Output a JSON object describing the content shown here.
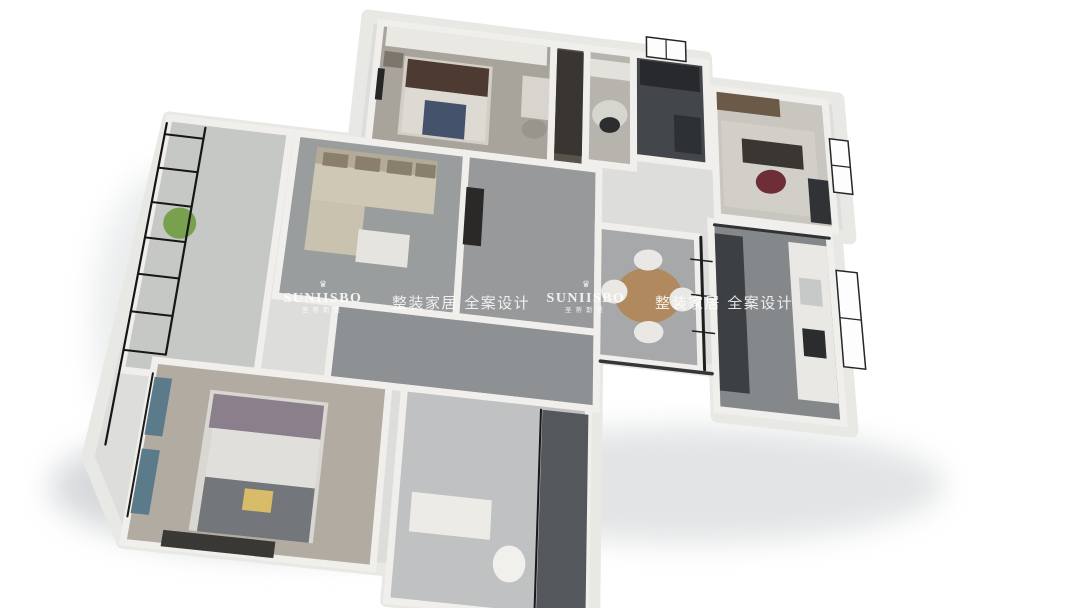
{
  "watermarks": [
    {
      "brand": "SUNIISBO",
      "brand_cn": "圣蒂斯堡",
      "tagline": "整装家居 全案设计",
      "crown_glyph": "♛"
    },
    {
      "brand": "SUNIISBO",
      "brand_cn": "圣蒂斯堡",
      "tagline": "整装家居 全案设计",
      "crown_glyph": "♛"
    }
  ],
  "floorplan": {
    "description": "3D isometric rendering of a three-bedroom apartment floor plan, white background",
    "colors": {
      "background": "#ffffff",
      "wall_fill": "#dddddc",
      "wall_inner": "#f0efec",
      "wall_outer": "#e8e8e5",
      "window_frame": "#26262a",
      "glass_black": "#17181a"
    },
    "projection": {
      "plan_quad": [
        [
          28,
          0
        ],
        [
          100,
          13
        ],
        [
          97,
          63
        ],
        [
          0,
          79
        ]
      ],
      "screen_quad": [
        [
          368,
          16
        ],
        [
          848,
          141
        ],
        [
          852,
          431
        ],
        [
          88,
          457
        ]
      ]
    },
    "shadows": [
      {
        "name": "shadow-bottom-left",
        "cx": 300,
        "cy": 487,
        "rx": 250,
        "ry": 68,
        "color": "#aeb4b8",
        "opacity": 0.5
      },
      {
        "name": "shadow-bottom-right",
        "cx": 690,
        "cy": 485,
        "rx": 255,
        "ry": 58,
        "color": "#b4b9bc",
        "opacity": 0.38
      },
      {
        "name": "shadow-left",
        "cx": 168,
        "cy": 320,
        "rx": 75,
        "ry": 150,
        "color": "#c2c7ca",
        "opacity": 0.32
      }
    ],
    "outline": [
      [
        28,
        0
      ],
      [
        79,
        0
      ],
      [
        79,
        5
      ],
      [
        99,
        5
      ],
      [
        99,
        31
      ],
      [
        97,
        31
      ],
      [
        97,
        63
      ],
      [
        79,
        63
      ],
      [
        79,
        56
      ],
      [
        63,
        56
      ],
      [
        63,
        94
      ],
      [
        38,
        94
      ],
      [
        38,
        90
      ],
      [
        6,
        90
      ],
      [
        0,
        79
      ],
      [
        2,
        24
      ],
      [
        28,
        24
      ]
    ],
    "rooms": [
      {
        "name": "bedroom-2",
        "rect": [
          30,
          1,
          56,
          24
        ],
        "floor": "#a8a39b"
      },
      {
        "name": "closet",
        "rect": [
          56,
          1,
          61,
          24
        ],
        "floor": "#57524a"
      },
      {
        "name": "dressing-nook",
        "rect": [
          61,
          1,
          68,
          23
        ],
        "floor": "#b7b4ae"
      },
      {
        "name": "bathroom-top",
        "rect": [
          68,
          1,
          79,
          21
        ],
        "floor": "#43464a"
      },
      {
        "name": "study",
        "rect": [
          80,
          6,
          97,
          30
        ],
        "floor": "#c9c6c0"
      },
      {
        "name": "hallway",
        "rect": [
          44,
          24,
          63,
          56
        ],
        "floor": "#97999b"
      },
      {
        "name": "corridor",
        "rect": [
          28,
          52,
          63,
          64
        ],
        "floor": "#8e9194"
      },
      {
        "name": "living-room",
        "rect": [
          20,
          24,
          44,
          52
        ],
        "floor": "#9a9d9e"
      },
      {
        "name": "balcony",
        "rect": [
          2,
          24,
          19,
          66
        ],
        "floor": "#c5c8c4"
      },
      {
        "name": "master-bedroom",
        "rect": [
          6,
          64,
          36,
          90
        ],
        "floor": "#b2aba1"
      },
      {
        "name": "bathroom-bottom",
        "rect": [
          38,
          64,
          62,
          94
        ],
        "floor": "#bfc1c3"
      },
      {
        "name": "dining-room",
        "rect": [
          63,
          34,
          77,
          56
        ],
        "floor": "#a6a8aa"
      },
      {
        "name": "kitchen",
        "rect": [
          79,
          31,
          96,
          62
        ],
        "floor": "#85888b"
      }
    ],
    "furniture": [
      {
        "name": "wardrobe",
        "shape": "rect",
        "rect": [
          31,
          1.5,
          55,
          5.5
        ],
        "color": "#e9e8e3"
      },
      {
        "name": "bed-2-base",
        "shape": "rect",
        "rect": [
          34,
          7,
          47,
          22
        ],
        "color": "#d3cec6"
      },
      {
        "name": "bed-2-headboard",
        "shape": "rect",
        "rect": [
          34.5,
          7.5,
          46.5,
          13
        ],
        "color": "#4d3a30"
      },
      {
        "name": "bed-2-duvet",
        "shape": "rect",
        "rect": [
          34.5,
          13,
          46.5,
          21.5
        ],
        "color": "#ddd9d3"
      },
      {
        "name": "bed-2-runner",
        "shape": "rect",
        "rect": [
          37.5,
          15,
          43.5,
          21.5
        ],
        "color": "#44536b"
      },
      {
        "name": "nightstand-2",
        "shape": "rect",
        "rect": [
          31,
          6.5,
          33.8,
          9.5
        ],
        "color": "#7d766c"
      },
      {
        "name": "tv-bedroom-2",
        "shape": "rect",
        "rect": [
          30.3,
          10,
          31.3,
          16
        ],
        "color": "#262626"
      },
      {
        "name": "desk-2",
        "shape": "rect",
        "rect": [
          51.5,
          8,
          55.5,
          16
        ],
        "color": "#d9d5ce"
      },
      {
        "name": "chair-2",
        "shape": "ellipse",
        "c": [
          53.5,
          18
        ],
        "r": [
          1.8,
          1.8
        ],
        "color": "#9a958c"
      },
      {
        "name": "closet-cabinet",
        "shape": "rect",
        "rect": [
          56.5,
          2,
          60.5,
          22
        ],
        "color": "#393530"
      },
      {
        "name": "nook-rug",
        "shape": "ellipse",
        "c": [
          64.5,
          13.5
        ],
        "r": [
          2.6,
          2.8
        ],
        "color": "#d7d5d0"
      },
      {
        "name": "nook-desk",
        "shape": "rect",
        "rect": [
          61.5,
          3,
          67.5,
          6.5
        ],
        "color": "#e3e1dc"
      },
      {
        "name": "nook-chair",
        "shape": "ellipse",
        "c": [
          64.5,
          15.5
        ],
        "r": [
          1.5,
          1.5
        ],
        "color": "#2c2d2f"
      },
      {
        "name": "bath-top-shower",
        "shape": "rect",
        "rect": [
          69,
          2,
          78,
          7
        ],
        "color": "#27292c"
      },
      {
        "name": "bath-top-vanity",
        "shape": "rect",
        "rect": [
          74,
          12,
          78,
          19
        ],
        "color": "#2e3134"
      },
      {
        "name": "study-shelf",
        "shape": "rect",
        "rect": [
          80.5,
          6.5,
          90,
          10
        ],
        "color": "#6b5a47"
      },
      {
        "name": "study-rug",
        "shape": "rect",
        "rect": [
          81,
          12,
          95,
          28
        ],
        "color": "#d2cfc9"
      },
      {
        "name": "study-desk",
        "shape": "rect",
        "rect": [
          84,
          15,
          93,
          19.5
        ],
        "color": "#3a3733"
      },
      {
        "name": "study-chair",
        "shape": "ellipse",
        "c": [
          88,
          22.5
        ],
        "r": [
          2.2,
          2.2
        ],
        "color": "#6d2e37"
      },
      {
        "name": "study-cabinet",
        "shape": "rect",
        "rect": [
          93.5,
          21,
          96.5,
          29
        ],
        "color": "#303336"
      },
      {
        "name": "hall-sideboard",
        "shape": "rect",
        "rect": [
          44.3,
          30,
          46.8,
          40
        ],
        "color": "#2b2927"
      },
      {
        "name": "sofa-back",
        "shape": "rect",
        "rect": [
          23,
          26,
          40,
          29
        ],
        "color": "#b3ab97"
      },
      {
        "name": "sofa-seat",
        "shape": "rect",
        "rect": [
          23,
          29,
          40,
          35.5
        ],
        "color": "#cfc8b5"
      },
      {
        "name": "sofa-chaise",
        "shape": "rect",
        "rect": [
          23,
          35.5,
          30.5,
          44
        ],
        "color": "#c9c2af"
      },
      {
        "name": "sofa-cushion-1",
        "shape": "rect",
        "rect": [
          24,
          26.8,
          27.5,
          29.2
        ],
        "color": "#897f6b"
      },
      {
        "name": "sofa-cushion-2",
        "shape": "rect",
        "rect": [
          28.5,
          26.8,
          32,
          29.2
        ],
        "color": "#897f6b"
      },
      {
        "name": "sofa-cushion-3",
        "shape": "rect",
        "rect": [
          33,
          26.8,
          36.5,
          29.2
        ],
        "color": "#897f6b"
      },
      {
        "name": "sofa-cushion-4",
        "shape": "rect",
        "rect": [
          37,
          26.8,
          39.8,
          29.2
        ],
        "color": "#897f6b"
      },
      {
        "name": "coffee-table",
        "shape": "rect",
        "rect": [
          30,
          39.5,
          37,
          45
        ],
        "color": "#e6e4df"
      },
      {
        "name": "balcony-plant",
        "shape": "ellipse",
        "c": [
          6,
          42
        ],
        "r": [
          2.2,
          2.6
        ],
        "color": "#79a04f"
      },
      {
        "name": "dining-table",
        "shape": "ellipse",
        "c": [
          70,
          45
        ],
        "r": [
          4.6,
          4.6
        ],
        "color": "#b08a5e"
      },
      {
        "name": "dining-chair-1",
        "shape": "ellipse",
        "c": [
          70,
          39
        ],
        "r": [
          2,
          1.8
        ],
        "color": "#e9e8e4"
      },
      {
        "name": "dining-chair-2",
        "shape": "ellipse",
        "c": [
          70,
          51
        ],
        "r": [
          2,
          1.8
        ],
        "color": "#e9e8e4"
      },
      {
        "name": "dining-chair-3",
        "shape": "ellipse",
        "c": [
          65.3,
          45
        ],
        "r": [
          1.8,
          2
        ],
        "color": "#e9e8e4"
      },
      {
        "name": "dining-chair-4",
        "shape": "ellipse",
        "c": [
          74.7,
          45
        ],
        "r": [
          1.8,
          2
        ],
        "color": "#e9e8e4"
      },
      {
        "name": "kitchen-cabinets",
        "shape": "rect",
        "rect": [
          79.5,
          33,
          83.5,
          59
        ],
        "color": "#3c4043"
      },
      {
        "name": "kitchen-counter",
        "shape": "rect",
        "rect": [
          90,
          33,
          95.5,
          59
        ],
        "color": "#e9e8e4"
      },
      {
        "name": "kitchen-sink",
        "shape": "rect",
        "rect": [
          91.2,
          39,
          94.3,
          43.5
        ],
        "color": "#c6c9c7"
      },
      {
        "name": "kitchen-stove",
        "shape": "rect",
        "rect": [
          91.2,
          47.5,
          94.3,
          52
        ],
        "color": "#2a2c2e"
      },
      {
        "name": "bath-bottom-vanity",
        "shape": "rect",
        "rect": [
          40,
          79,
          50,
          84.5
        ],
        "color": "#edebe6"
      },
      {
        "name": "toilet",
        "shape": "ellipse",
        "c": [
          52.5,
          87.5
        ],
        "r": [
          2,
          2.5
        ],
        "color": "#f1f0ed"
      },
      {
        "name": "shower-dark",
        "shape": "rect",
        "rect": [
          56,
          65,
          62,
          93
        ],
        "color": "#54585c"
      },
      {
        "name": "master-bed-base",
        "shape": "rect",
        "rect": [
          13.5,
          67.5,
          28.5,
          87.5
        ],
        "color": "#d9d7d1"
      },
      {
        "name": "master-pillows",
        "shape": "rect",
        "rect": [
          14,
          68,
          28,
          73
        ],
        "color": "#8b7f8c"
      },
      {
        "name": "master-duvet",
        "shape": "rect",
        "rect": [
          14.5,
          73,
          28,
          80
        ],
        "color": "#e1dfdb"
      },
      {
        "name": "master-blanket",
        "shape": "rect",
        "rect": [
          14.5,
          80,
          28,
          87.5
        ],
        "color": "#73767a"
      },
      {
        "name": "master-yellow-pillow",
        "shape": "rect",
        "rect": [
          19.5,
          81,
          23,
          84
        ],
        "color": "#d8bc6a"
      },
      {
        "name": "master-curtain-1",
        "shape": "rect",
        "rect": [
          6.3,
          66.5,
          8.5,
          75
        ],
        "color": "#5b7a8a"
      },
      {
        "name": "master-curtain-2",
        "shape": "rect",
        "rect": [
          6.3,
          77,
          8.5,
          86
        ],
        "color": "#5b7a8a"
      },
      {
        "name": "master-dresser",
        "shape": "rect",
        "rect": [
          10.5,
          87.8,
          24,
          90
        ],
        "color": "#3a3835"
      }
    ],
    "lines": [
      {
        "name": "balcony-glass-rail-outer",
        "pts": [
          [
            1.8,
            25
          ],
          [
            1.8,
            77
          ]
        ],
        "color": "#161616",
        "w": 2.2
      },
      {
        "name": "balcony-glass-rail-inner",
        "pts": [
          [
            7.2,
            25
          ],
          [
            7.2,
            63
          ]
        ],
        "color": "#161616",
        "w": 2.2
      },
      {
        "name": "balcony-glass-rung-1",
        "pts": [
          [
            1.8,
            27
          ],
          [
            7.2,
            27
          ]
        ],
        "color": "#161616",
        "w": 2
      },
      {
        "name": "balcony-glass-rung-2",
        "pts": [
          [
            1.8,
            33
          ],
          [
            7.2,
            33
          ]
        ],
        "color": "#161616",
        "w": 2
      },
      {
        "name": "balcony-glass-rung-3",
        "pts": [
          [
            1.8,
            39
          ],
          [
            7.2,
            39
          ]
        ],
        "color": "#161616",
        "w": 2
      },
      {
        "name": "balcony-glass-rung-4",
        "pts": [
          [
            1.8,
            45
          ],
          [
            7.2,
            45
          ]
        ],
        "color": "#161616",
        "w": 2
      },
      {
        "name": "balcony-glass-rung-5",
        "pts": [
          [
            1.8,
            51
          ],
          [
            7.2,
            51
          ]
        ],
        "color": "#161616",
        "w": 2
      },
      {
        "name": "balcony-glass-rung-6",
        "pts": [
          [
            1.8,
            57
          ],
          [
            7.2,
            57
          ]
        ],
        "color": "#161616",
        "w": 2
      },
      {
        "name": "balcony-glass-rung-7",
        "pts": [
          [
            1.8,
            63
          ],
          [
            7.2,
            63
          ]
        ],
        "color": "#161616",
        "w": 2
      },
      {
        "name": "master-window-frame",
        "pts": [
          [
            6,
            66
          ],
          [
            6,
            86.5
          ]
        ],
        "color": "#1a1a1a",
        "w": 2
      },
      {
        "name": "dining-partition-glass",
        "pts": [
          [
            77.5,
            34
          ],
          [
            77.5,
            56
          ]
        ],
        "color": "#1d1f21",
        "w": 3
      },
      {
        "name": "partition-tick-1",
        "pts": [
          [
            76,
            38
          ],
          [
            79,
            38
          ]
        ],
        "color": "#1d1f21",
        "w": 1.5
      },
      {
        "name": "partition-tick-2",
        "pts": [
          [
            76,
            44
          ],
          [
            79,
            44
          ]
        ],
        "color": "#1d1f21",
        "w": 1.5
      },
      {
        "name": "partition-tick-3",
        "pts": [
          [
            76,
            50
          ],
          [
            79,
            50
          ]
        ],
        "color": "#1d1f21",
        "w": 1.5
      },
      {
        "name": "dining-wall-cap",
        "pts": [
          [
            63.5,
            56.5
          ],
          [
            78.5,
            56.5
          ]
        ],
        "color": "#34373a",
        "w": 3.5
      },
      {
        "name": "kitchen-hood-cap",
        "pts": [
          [
            79.5,
            31.5
          ],
          [
            96,
            31.5
          ]
        ],
        "color": "#303336",
        "w": 3
      },
      {
        "name": "shower-glass",
        "pts": [
          [
            55.8,
            65
          ],
          [
            55.8,
            93
          ]
        ],
        "color": "#17181a",
        "w": 2
      }
    ],
    "windows": [
      {
        "name": "window-bathroom-top",
        "pts": [
          [
            70,
            -2.8
          ],
          [
            76,
            -2.8
          ],
          [
            76,
            1.2
          ],
          [
            70,
            1.2
          ]
        ],
        "mullion": [
          [
            73,
            -2.8
          ],
          [
            73,
            1.2
          ]
        ]
      },
      {
        "name": "window-kitchen",
        "pts": [
          [
            96.6,
            37
          ],
          [
            99.6,
            37
          ],
          [
            99.6,
            53
          ],
          [
            96.6,
            53
          ]
        ],
        "mullion": [
          [
            96.6,
            45
          ],
          [
            99.6,
            45
          ]
        ]
      },
      {
        "name": "window-study",
        "pts": [
          [
            97.2,
            13
          ],
          [
            100,
            13
          ],
          [
            100,
            23
          ],
          [
            97.2,
            23
          ]
        ],
        "mullion": [
          [
            97.2,
            18
          ],
          [
            100,
            18
          ]
        ]
      }
    ]
  }
}
